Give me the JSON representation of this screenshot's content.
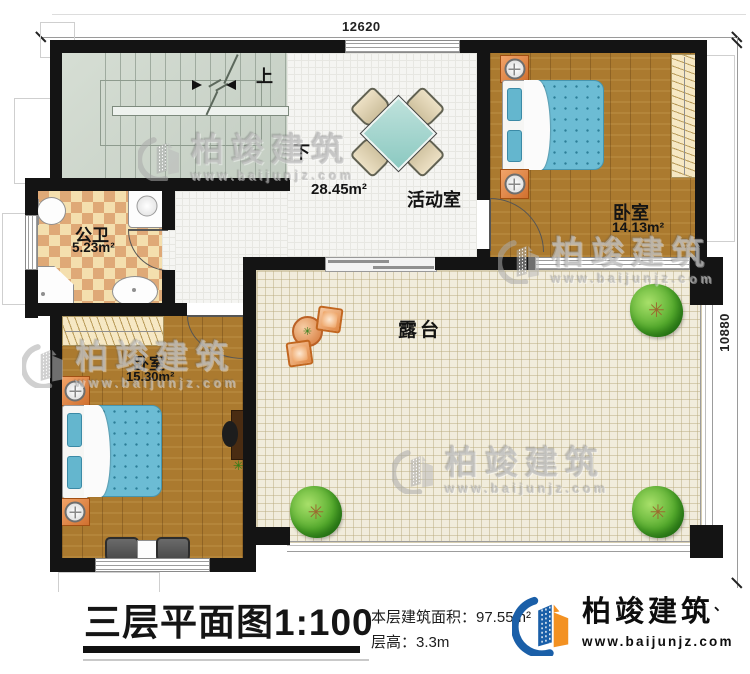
{
  "dimensions": {
    "top": "12620",
    "right": "10880"
  },
  "rooms": {
    "stairs": {
      "up_label": "上",
      "down_label": "下"
    },
    "activity": {
      "name": "活动室",
      "area": "28.45m²"
    },
    "bedroom_top": {
      "name": "卧室",
      "area": "14.13m²"
    },
    "bathroom": {
      "name": "公卫",
      "area": "5.23m²"
    },
    "bedroom_bottom": {
      "name": "卧室",
      "area": "15.30m²"
    },
    "terrace": {
      "name": "露台"
    }
  },
  "title_block": {
    "title": "三层平面图1:100",
    "area_line": "本层建筑面积：97.55m²",
    "height_line": "层高：3.3m"
  },
  "brand": {
    "name": "柏竣建筑",
    "tick": "、",
    "url": "www.baijunjz.com"
  },
  "colors": {
    "wall": "#141414",
    "wood_floor": "#ab7a2f",
    "stair_floor": "#ccd5cb",
    "bath_tile_light": "#f4dfae",
    "bath_tile_dark": "#dfa977",
    "terrace_floor": "#f1ecdc",
    "bed": "#6cbcd4",
    "furniture_orange": "#e08744",
    "tree_green": "#55ab2d",
    "brand_blue": "#1a5fa8",
    "brand_orange": "#f39122"
  }
}
